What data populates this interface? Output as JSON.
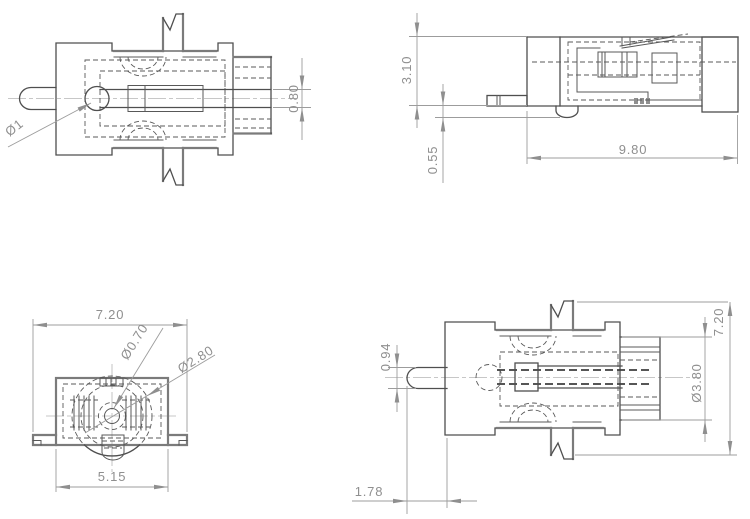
{
  "drawing": {
    "background_color": "#ffffff",
    "outline_color": "#4f4f4f",
    "dimension_color": "#8f8f8f",
    "views": {
      "side_section": {
        "dims": {
          "pin_diameter": "Ø1",
          "slot_width": "0.80"
        }
      },
      "top": {
        "dims": {
          "body_height": "3.10",
          "boss_protrusion": "0.55",
          "overall_length": "9.80"
        }
      },
      "front": {
        "dims": {
          "overall_width": "7.20",
          "center_hole_diameter": "Ø0.70",
          "inner_boss_diameter": "Ø2.80",
          "body_width": "5.15"
        }
      },
      "side": {
        "dims": {
          "pin_thickness": "0.94",
          "pin_protrusion": "1.78",
          "boss_diameter": "Ø3.80",
          "overall_height": "7.20"
        }
      }
    }
  }
}
